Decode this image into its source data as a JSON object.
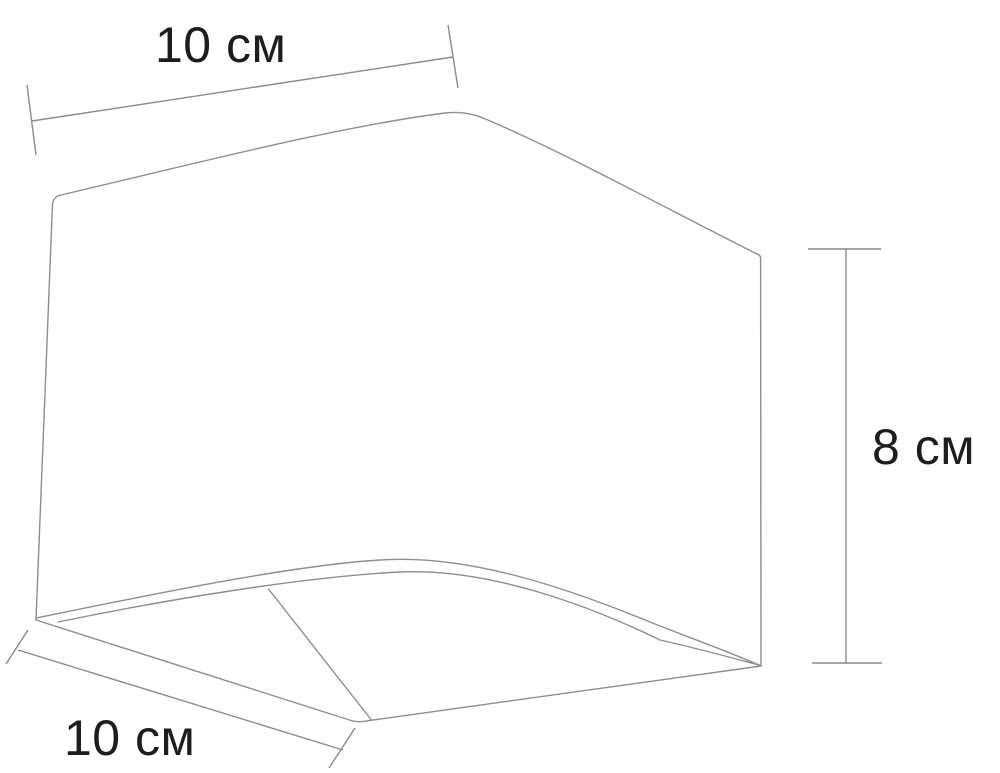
{
  "figure": {
    "description": "Technical line drawing of a cube-shaped fixture viewed from below-front, with three dimension callouts"
  },
  "colors": {
    "background": "#ffffff",
    "line": "#8e8e8e",
    "text": "#1d1d1d"
  },
  "dimensions": {
    "top_width": {
      "label": "10 см",
      "value": 10,
      "unit": "см",
      "orientation": "slanted horizontal, top"
    },
    "bottom_depth": {
      "label": "10 см",
      "value": 10,
      "unit": "см",
      "orientation": "slanted horizontal, bottom-left"
    },
    "right_height": {
      "label": "8 см",
      "value": 8,
      "unit": "см",
      "orientation": "vertical, right"
    }
  }
}
